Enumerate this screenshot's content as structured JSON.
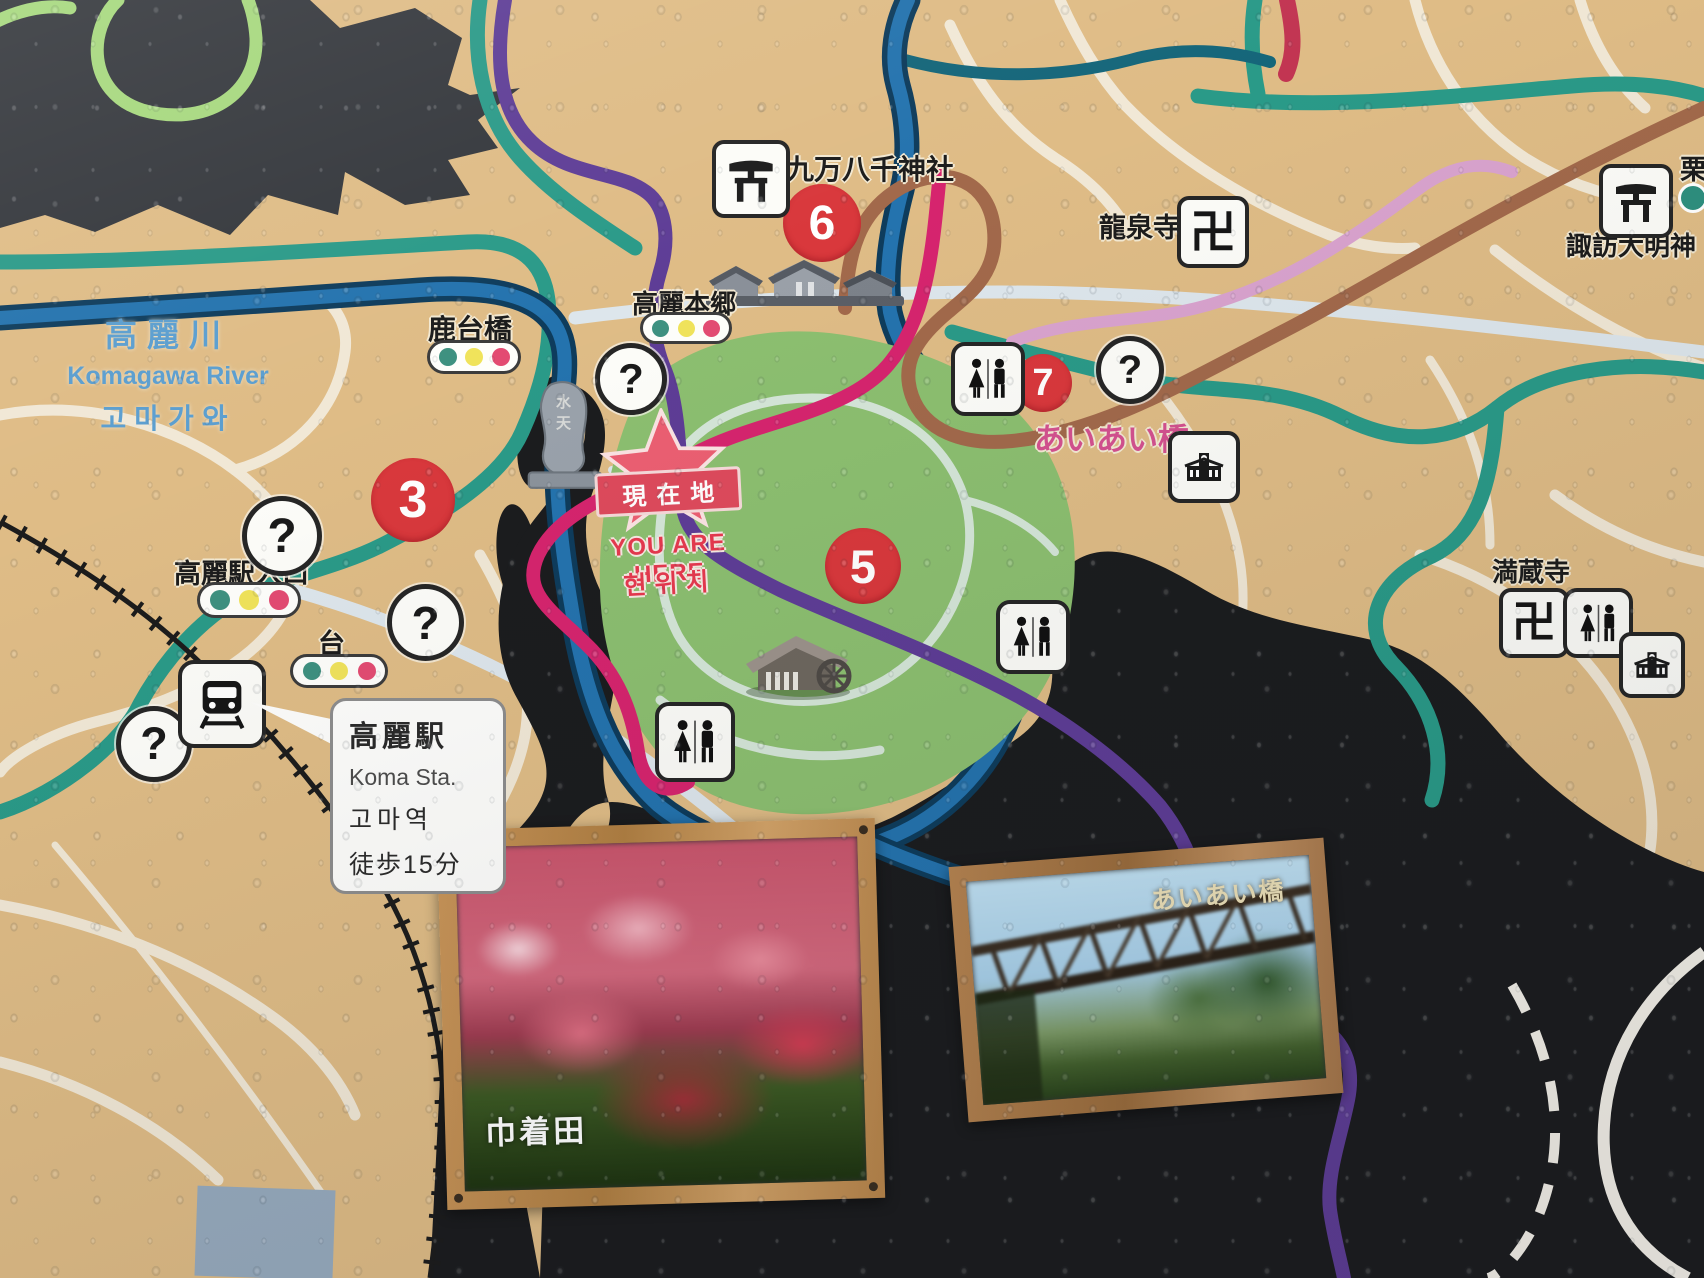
{
  "sign": {
    "river": {
      "ja": "高麗川",
      "en": "Komagawa River",
      "ko": "고마가와"
    },
    "you_are_here": {
      "banner": "現在地",
      "en": "YOU ARE HERE",
      "ko": "현위치"
    },
    "station_callout": {
      "ja": "高麗駅",
      "en": "Koma Sta.",
      "ko": "고마역",
      "walk": "徒歩15分"
    },
    "labels": {
      "shikadaibashi": "鹿台橋",
      "koma_hongo": "高麗本郷",
      "kumanhassen_jinja": "九万八千神社",
      "ryusenji": "龍泉寺",
      "suwa_daimyojin": "諏訪大明神",
      "kuri": "栗",
      "aiaibashi": "あいあい橋",
      "manzoji": "満蔵寺",
      "koma_eki_iriguchi": "高麗駅入口",
      "dai": "台",
      "monument": "水天"
    },
    "markers": {
      "m3": "3",
      "m5": "5",
      "m6": "6",
      "m7": "7"
    },
    "glyphs": {
      "question": "?",
      "manji": "卍"
    },
    "photos": {
      "left_caption": "巾着田",
      "right_caption": "あいあい橋"
    },
    "colors": {
      "map_base": "#dfbc86",
      "mountain_dark": "#34373c",
      "forest_black": "#1b1c1e",
      "river_blue": "#2473ae",
      "park_green": "#8cbf70",
      "route_teal": "#2a9a88",
      "route_purple": "#5e3d96",
      "route_magenta": "#d6246e",
      "route_brown": "#a2694b",
      "route_light_pink": "#d9a3ce",
      "route_crimson": "#c23552",
      "route_light_green": "#a6d87d",
      "marker_red": "#d9383c",
      "river_label_blue": "#5b9ecf",
      "aiai_label_pink": "#d4518f"
    }
  }
}
